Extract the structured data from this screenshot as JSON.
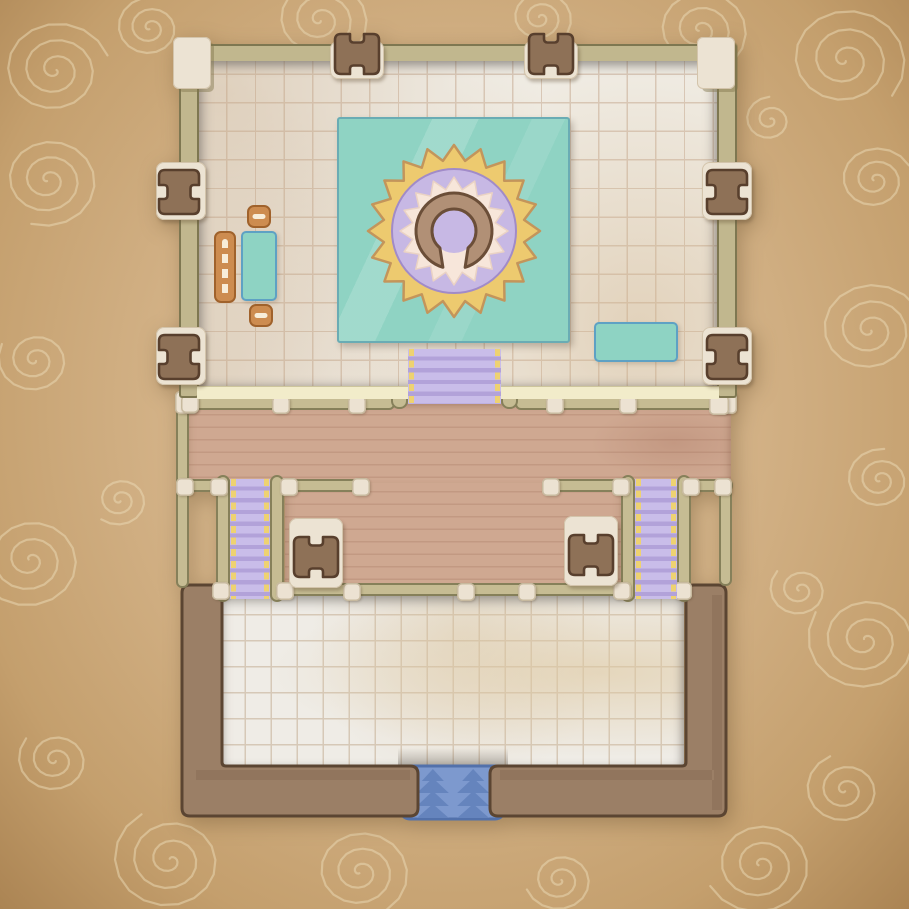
{
  "map_type": "top-down fantasy temple battle map on parchment",
  "palette": {
    "parchment_mid": "#d3b287",
    "parchment_light": "#e0c69e",
    "parchment_dark": "#b99259",
    "swirl": "#ecdcb8",
    "wall_olive": "#c1b78e",
    "wall_outline": "#7e7751",
    "cream_block": "#ece3d3",
    "cream_outline": "#d3c4ab",
    "door_brown": "#8e7157",
    "door_outline": "#583f2d",
    "floor_top": "#f2f0ea",
    "floor_grid": "#d9c9ba",
    "floor_bottom": "#efece6",
    "floor_bottom_grid": "#d6c8b7",
    "pale_wall_strip": "#f2ecca",
    "deck_wood": "#cfa891",
    "rail_olive": "#c6bc93",
    "rail_outline": "#86805a",
    "post_cream": "#ece2d2",
    "stair_purple": "#c9bde9",
    "stair_step": "#b2a2d9",
    "stair_edge_yellow": "#eed271",
    "stair_blue": "#7d99ce",
    "stair_blue_chevron": "#6584bd",
    "stair_blue_outline": "#5271ab",
    "bottom_wall": "#9b7f66",
    "bottom_wall_outline": "#5b4532",
    "rug_teal": "#8fd3c3",
    "rug_outline": "#6aacb4",
    "sun_yellow": "#edca6f",
    "sun_outline": "#c3955b",
    "disc_purple": "#c7b8e4",
    "disc_outline": "#a18bc8",
    "burst_cream": "#f7e6da",
    "burst_outline": "#ead2c4",
    "omega_brown": "#b19076",
    "omega_outline": "#6b4e38",
    "furniture_orange": "#cd8c50",
    "furniture_orange_outline": "#a0622c",
    "furniture_dash": "#f8edd9",
    "table_teal": "#8ed3c3",
    "table_outline": "#5ea1c4"
  },
  "doors": [
    {
      "id": "hall-north-door-west",
      "x": 334,
      "y": 33,
      "orient": "v",
      "pad": [
        330,
        41,
        54,
        38
      ]
    },
    {
      "id": "hall-north-door-east",
      "x": 528,
      "y": 33,
      "orient": "v",
      "pad": [
        524,
        41,
        54,
        38
      ]
    },
    {
      "id": "hall-west-door-north",
      "x": 158,
      "y": 169,
      "orient": "h",
      "pad": [
        156,
        162,
        50,
        58
      ]
    },
    {
      "id": "hall-west-door-south",
      "x": 158,
      "y": 334,
      "orient": "h",
      "pad": [
        156,
        327,
        50,
        58
      ]
    },
    {
      "id": "hall-east-door-north",
      "x": 706,
      "y": 169,
      "orient": "h",
      "pad": [
        702,
        162,
        50,
        58
      ]
    },
    {
      "id": "hall-east-door-south",
      "x": 706,
      "y": 334,
      "orient": "h",
      "pad": [
        702,
        327,
        50,
        58
      ]
    },
    {
      "id": "deck-door-west",
      "x": 293,
      "y": 536,
      "orient": "v",
      "pad": [
        289,
        518,
        54,
        70
      ]
    },
    {
      "id": "deck-door-east",
      "x": 568,
      "y": 534,
      "orient": "v",
      "pad": [
        564,
        516,
        54,
        70
      ]
    }
  ],
  "rails": [
    [
      183,
      396,
      212,
      14
    ],
    [
      515,
      396,
      222,
      14
    ],
    [
      176,
      479,
      57,
      13
    ],
    [
      280,
      479,
      85,
      13
    ],
    [
      542,
      479,
      83,
      13
    ],
    [
      688,
      479,
      45,
      13
    ],
    [
      284,
      583,
      341,
      13
    ],
    [
      176,
      396,
      13,
      192
    ],
    [
      719,
      478,
      13,
      108
    ]
  ],
  "stair_rails": [
    [
      216,
      475,
      14,
      127
    ],
    [
      270,
      475,
      14,
      127
    ],
    [
      621,
      475,
      14,
      127
    ],
    [
      677,
      475,
      14,
      127
    ],
    [
      391,
      343,
      17,
      66
    ],
    [
      501,
      343,
      17,
      66
    ]
  ],
  "posts": [
    [
      175,
      391,
      23
    ],
    [
      714,
      391,
      23
    ],
    [
      181,
      395,
      18
    ],
    [
      272,
      396,
      18
    ],
    [
      348,
      396,
      18
    ],
    [
      546,
      396,
      18
    ],
    [
      619,
      396,
      18
    ],
    [
      709,
      395,
      20
    ],
    [
      176,
      478,
      18
    ],
    [
      210,
      478,
      18
    ],
    [
      280,
      478,
      18
    ],
    [
      352,
      478,
      18
    ],
    [
      542,
      478,
      18
    ],
    [
      612,
      478,
      18
    ],
    [
      682,
      478,
      18
    ],
    [
      714,
      478,
      18
    ],
    [
      212,
      582,
      18
    ],
    [
      276,
      582,
      18
    ],
    [
      343,
      583,
      18
    ],
    [
      457,
      583,
      18
    ],
    [
      518,
      583,
      18
    ],
    [
      613,
      582,
      18
    ],
    [
      674,
      582,
      18
    ]
  ],
  "staircases": [
    {
      "id": "stairs-west",
      "x": 230,
      "y": 479,
      "w": 40,
      "h": 120
    },
    {
      "id": "stairs-east",
      "x": 635,
      "y": 479,
      "w": 42,
      "h": 120
    },
    {
      "id": "stairs-hall-to-deck",
      "x": 408,
      "y": 349,
      "w": 93,
      "h": 55
    }
  ],
  "blue_stairs": {
    "x": 397,
    "y": 763,
    "w": 112,
    "h": 60,
    "columns": 2,
    "chevrons_per_column": 4
  },
  "mandala": {
    "cx": 117,
    "cy": 114,
    "sun": {
      "points": 20,
      "r_outer": 86,
      "r_inner": 71
    },
    "disc_r": 62,
    "burst": {
      "points": 16,
      "r_outer": 54,
      "r_inner": 42
    },
    "omega": {
      "r_outer": 38,
      "r_inner": 22,
      "outer_half_deg": 17,
      "inner_half_deg": 40
    },
    "center_r": 22
  },
  "furniture": [
    {
      "id": "hall-bench",
      "type": "bench",
      "x": 214,
      "y": 231,
      "w": 22,
      "h": 72
    },
    {
      "id": "hall-table",
      "type": "table",
      "x": 241,
      "y": 231,
      "w": 36,
      "h": 70
    },
    {
      "id": "hall-chair-north",
      "type": "chair",
      "x": 247,
      "y": 205,
      "w": 24,
      "h": 23
    },
    {
      "id": "hall-chair-south",
      "type": "chair",
      "x": 249,
      "y": 304,
      "w": 24,
      "h": 23
    },
    {
      "id": "hall-side-table",
      "type": "table",
      "x": 594,
      "y": 322,
      "w": 84,
      "h": 40
    }
  ],
  "swirls": [
    [
      55,
      70,
      1.6,
      3,
      0
    ],
    [
      150,
      28,
      1.2,
      2.5,
      2
    ],
    [
      320,
      20,
      1.4,
      3,
      1
    ],
    [
      540,
      18,
      1.1,
      2.5,
      4
    ],
    [
      700,
      30,
      1.5,
      3,
      2.5
    ],
    [
      845,
      60,
      1.8,
      3,
      1
    ],
    [
      875,
      180,
      1.3,
      2.5,
      3
    ],
    [
      870,
      330,
      1.6,
      3,
      0.5
    ],
    [
      880,
      480,
      1.2,
      2.5,
      2
    ],
    [
      865,
      640,
      1.7,
      3,
      4
    ],
    [
      845,
      790,
      1.4,
      2.5,
      1.5
    ],
    [
      760,
      865,
      1.6,
      3,
      3
    ],
    [
      560,
      880,
      1.2,
      2.5,
      0
    ],
    [
      360,
      872,
      1.5,
      3,
      2
    ],
    [
      170,
      860,
      1.7,
      3,
      4.5
    ],
    [
      55,
      760,
      1.3,
      2.5,
      1
    ],
    [
      30,
      560,
      1.6,
      3,
      3.5
    ],
    [
      35,
      360,
      1.3,
      2.5,
      0.8
    ],
    [
      48,
      180,
      1.5,
      3,
      2.2
    ],
    [
      770,
      120,
      1.1,
      2,
      5
    ],
    [
      800,
      590,
      1.2,
      2.2,
      2.8
    ],
    [
      120,
      500,
      1.1,
      2.2,
      1.2
    ]
  ]
}
